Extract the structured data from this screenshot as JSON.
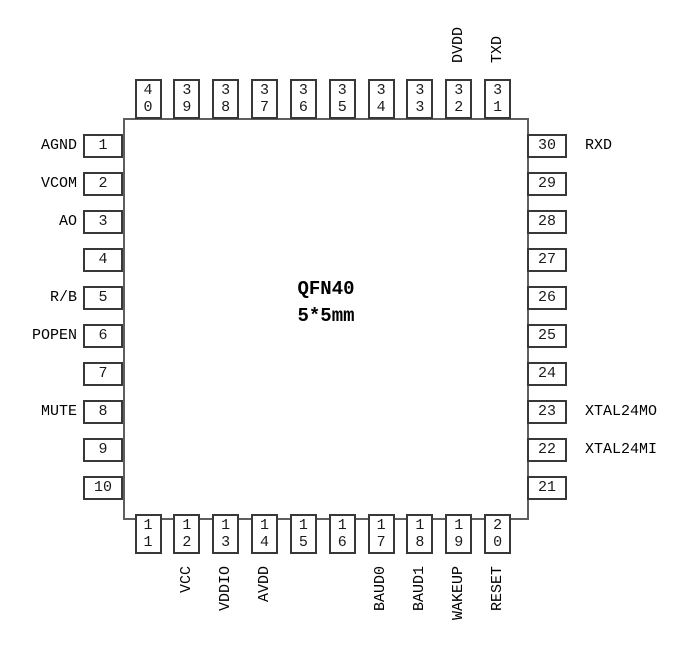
{
  "chip": {
    "name": "QFN40",
    "size": "5*5mm"
  },
  "colors": {
    "background": "#ffffff",
    "chip_border": "#5f5f5f",
    "pin_border": "#383838",
    "text": "#000000"
  },
  "pins": {
    "left_top_to_bottom": [
      {
        "num": "1",
        "label": "AGND"
      },
      {
        "num": "2",
        "label": "VCOM"
      },
      {
        "num": "3",
        "label": "AO"
      },
      {
        "num": "4",
        "label": ""
      },
      {
        "num": "5",
        "label": "R/B"
      },
      {
        "num": "6",
        "label": "POPEN"
      },
      {
        "num": "7",
        "label": ""
      },
      {
        "num": "8",
        "label": "MUTE"
      },
      {
        "num": "9",
        "label": ""
      },
      {
        "num": "10",
        "label": ""
      }
    ],
    "top_left_to_right": [
      {
        "num": "40",
        "label": ""
      },
      {
        "num": "39",
        "label": ""
      },
      {
        "num": "38",
        "label": ""
      },
      {
        "num": "37",
        "label": ""
      },
      {
        "num": "36",
        "label": ""
      },
      {
        "num": "35",
        "label": ""
      },
      {
        "num": "34",
        "label": ""
      },
      {
        "num": "33",
        "label": ""
      },
      {
        "num": "32",
        "label": "DVDD"
      },
      {
        "num": "31",
        "label": "TXD"
      }
    ],
    "right_top_to_bottom": [
      {
        "num": "30",
        "label": "RXD"
      },
      {
        "num": "29",
        "label": ""
      },
      {
        "num": "28",
        "label": ""
      },
      {
        "num": "27",
        "label": ""
      },
      {
        "num": "26",
        "label": ""
      },
      {
        "num": "25",
        "label": ""
      },
      {
        "num": "24",
        "label": ""
      },
      {
        "num": "23",
        "label": "XTAL24MO"
      },
      {
        "num": "22",
        "label": "XTAL24MI"
      },
      {
        "num": "21",
        "label": ""
      }
    ],
    "bottom_left_to_right": [
      {
        "num": "11",
        "label": ""
      },
      {
        "num": "12",
        "label": "VCC"
      },
      {
        "num": "13",
        "label": "VDDIO"
      },
      {
        "num": "14",
        "label": "AVDD"
      },
      {
        "num": "15",
        "label": ""
      },
      {
        "num": "16",
        "label": ""
      },
      {
        "num": "17",
        "label": "BAUD0"
      },
      {
        "num": "18",
        "label": "BAUD1"
      },
      {
        "num": "19",
        "label": "WAKEUP"
      },
      {
        "num": "20",
        "label": "RESET"
      }
    ]
  }
}
